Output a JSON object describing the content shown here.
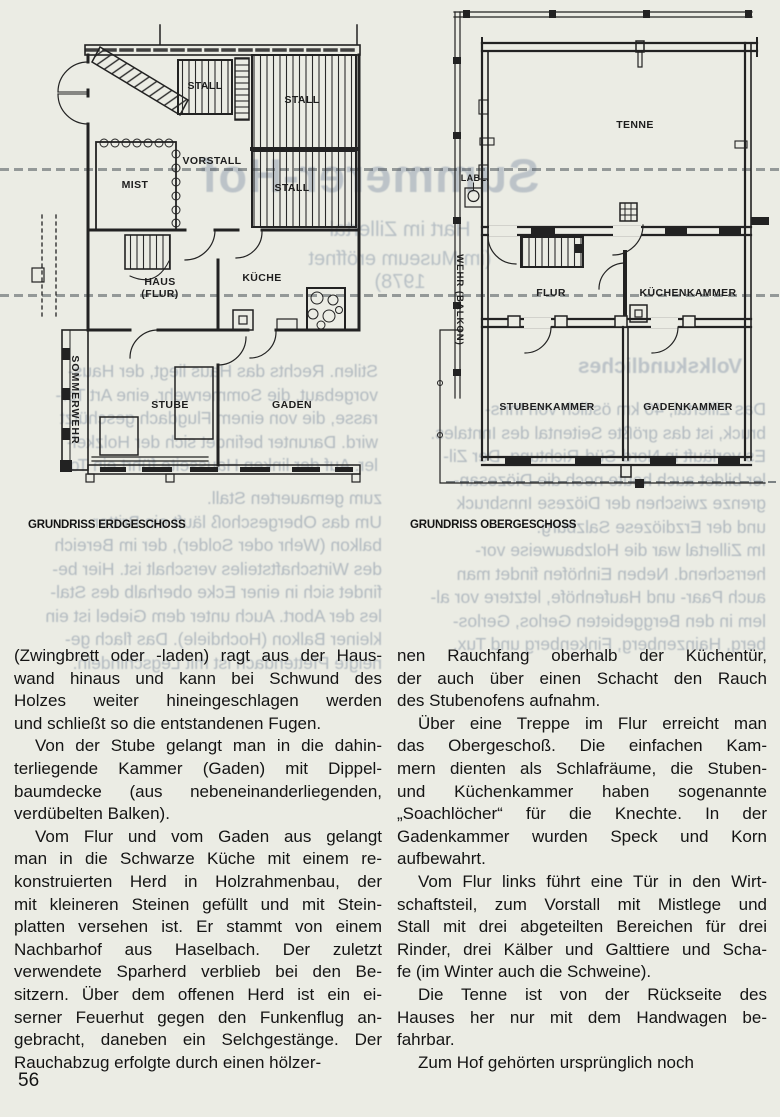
{
  "page": {
    "number": "56",
    "background": "#ebece4",
    "ink": "#161616",
    "bleed_color": "#b2bac0"
  },
  "plans": {
    "erdgeschoss": {
      "caption": "GRUNDRISS ERDGESCHOSS",
      "labels": {
        "stall_small": "STALL",
        "stall_top": "STALL",
        "stall_mid": "STALL",
        "vorstall": "VORSTALL",
        "mist": "MIST",
        "haus": "HAUS",
        "haus2": "(FLUR)",
        "kueche": "KÜCHE",
        "sommerwehr": "SOMMERWEHR",
        "stube": "STUBE",
        "gaden": "GADEN"
      }
    },
    "obergeschoss": {
      "caption": "GRUNDRISS OBERGESCHOSS",
      "labels": {
        "tenne": "TENNE",
        "labl": "LABL.",
        "wehr": "WEHR (BALKON)",
        "flur": "FLUR",
        "kuechenkammer": "KÜCHENKAMMER",
        "stubenkammer": "STUBENKAMMER",
        "gadenkammer": "GADENKAMMER"
      }
    }
  },
  "columns": {
    "left": {
      "paragraphs": [
        {
          "indent": false,
          "lines": [
            "(Zwingbrett oder -laden) ragt aus der Haus-",
            "wand hinaus und kann bei Schwund des",
            "Holzes weiter hineingeschlagen werden",
            "und schließt so die entstandenen Fugen."
          ]
        },
        {
          "indent": true,
          "lines": [
            "Von der Stube gelangt man in die dahin-",
            "terliegende Kammer (Gaden) mit Dippel-",
            "baumdecke (aus nebeneinanderliegenden,",
            "verdübelten Balken)."
          ]
        },
        {
          "indent": true,
          "lines": [
            "Vom Flur und vom Gaden aus gelangt",
            "man in die Schwarze Küche mit einem re-",
            "konstruierten Herd in Holzrahmenbau, der",
            "mit kleineren Steinen gefüllt und mit Stein-",
            "platten versehen ist. Er stammt von einem",
            "Nachbarhof aus Haselbach. Der zuletzt",
            "verwendete Sparherd verblieb bei den Be-",
            "sitzern. Über dem offenen Herd ist ein ei-",
            "serner Feuerhut gegen den Funkenflug an-",
            "gebracht, daneben ein Selchgestänge. Der",
            "Rauchabzug erfolgte durch einen hölzer-"
          ]
        }
      ]
    },
    "right": {
      "paragraphs": [
        {
          "indent": false,
          "lines": [
            "nen Rauchfang oberhalb der Küchentür,",
            "der auch über einen Schacht den Rauch",
            "des Stubenofens aufnahm."
          ]
        },
        {
          "indent": true,
          "lines": [
            "Über eine Treppe im Flur erreicht man",
            "das Obergeschoß. Die einfachen Kam-",
            "mern dienten als Schlafräume, die Stuben-",
            "und Küchenkammer haben sogenannte",
            "„Soachlöcher“ für die Knechte. In der",
            "Gadenkammer wurden Speck und Korn",
            "aufbewahrt."
          ]
        },
        {
          "indent": true,
          "lines": [
            "Vom Flur links führt eine Tür in den Wirt-",
            "schaftsteil, zum Vorstall mit Mistlege und",
            "Stall mit drei abgeteilten Bereichen für drei",
            "Rinder, drei Kälber und Galttiere und Scha-",
            "fe (im Winter auch die Schweine)."
          ]
        },
        {
          "indent": true,
          "lines": [
            "Die Tenne ist von der Rückseite des",
            "Hauses her nur mit dem Handwagen be-",
            "fahrbar."
          ]
        },
        {
          "indent": true,
          "lines": [
            "Zum Hof gehörten ursprünglich noch"
          ]
        }
      ]
    }
  },
  "bleedthrough": {
    "headline": "Summerer-Hof",
    "subline1": "Hart im Zillertal",
    "subline2": "(im Museum eröffnet 1978)",
    "heading2": "Volkskundliches",
    "block_plan": [
      "Stilen. Rechts das Haus liegt, der Haus-",
      "vorgebaut, die Sommerwehr, eine Art Ter-",
      "rasse, die von einem Flugdach geschützt",
      "wird. Darunter befindet sich der Holzkel-",
      "ler. Auf der linken Hausseite führt ein Tor"
    ],
    "block_left": [
      "zum gemauerten Stall.",
      "Um das Obergeschoß läuft ein Britter-",
      "balkon (Wehr oder Solder), der im Bereich",
      "des Wirtschaftsteiles verschalt ist. Hier be-",
      "findet sich in einer Ecke oberhalb des Stal-",
      "les der Abort. Auch unter dem Giebel ist ein",
      "kleiner Balkon (Hochdiele). Das flach ge-",
      "neigte Pfettendach ist mit Legschindeln."
    ],
    "block_right": [
      "Das Zillertal, 40 km östlich von Inns-",
      "bruck, ist das größte Seitental des Inntales.",
      "Es verläuft in Nord-Süd-Richtung. Der Zil-",
      "ler bildet auch heute noch die Diözesan-",
      "grenze zwischen der Diözese Innsbruck",
      "und der Erzdiözese Salzburg.",
      "Im Zillertal war die Holzbauweise vor-",
      "herrschend. Neben Einhöfen findet man",
      "auch Paar- und Haufenhöfe, letztere vor al-",
      "lem in den Berggebieten Gerlos, Gerlos-",
      "berg, Hainzenberg, Finkenberg und Tux."
    ]
  }
}
